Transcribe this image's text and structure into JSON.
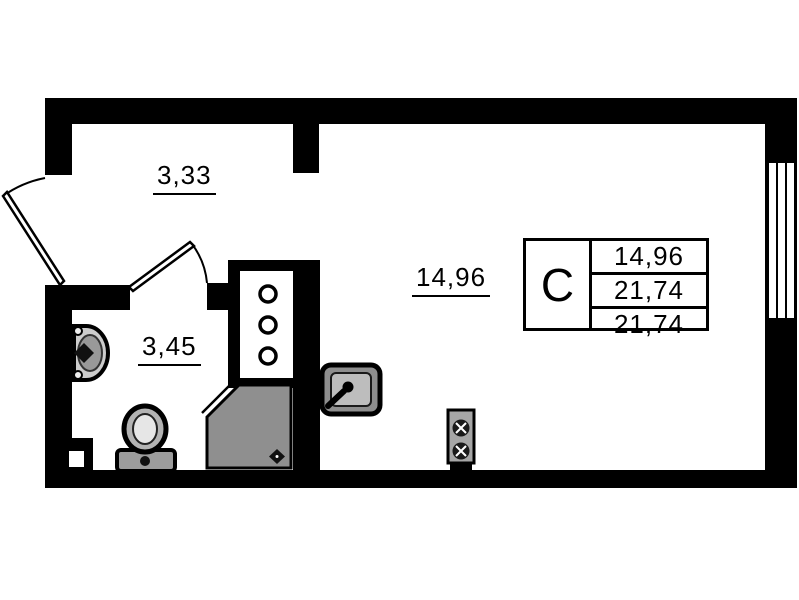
{
  "floorplan": {
    "rooms": {
      "hallway": {
        "area": "3,33"
      },
      "bathroom": {
        "area": "3,45"
      },
      "living": {
        "area": "14,96"
      }
    },
    "stamp": {
      "type": "С",
      "rows": [
        "14,96",
        "21,74",
        "21,74"
      ]
    },
    "colors": {
      "wall": "#000000",
      "background": "#ffffff",
      "shower_fill": "#8f8f8f",
      "fixture_gray": "#9c9c9c"
    }
  }
}
